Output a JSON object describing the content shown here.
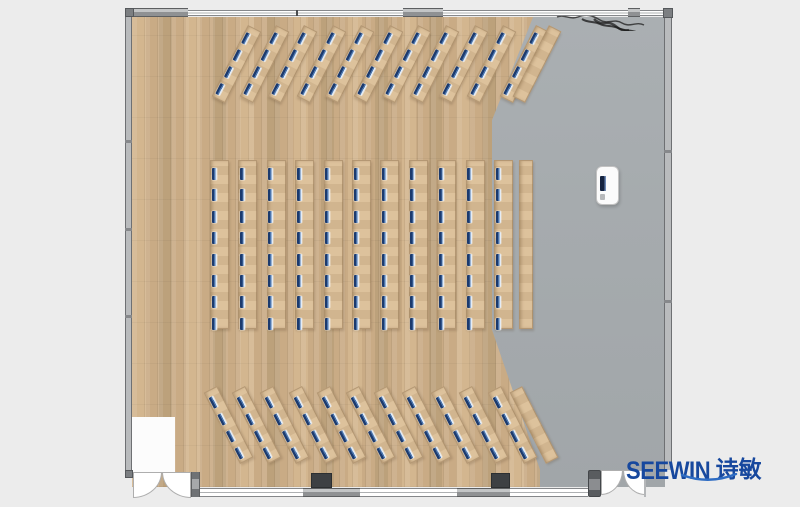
{
  "title": "training-room floor plan",
  "logo": {
    "brand": "SEEWIN",
    "cn": "诗敏"
  },
  "theme": {
    "bg": "#ececec",
    "wood": "#c9ab85",
    "wood_hi": "#d3b68f",
    "wood_lo": "#bca17b",
    "gray_floor": "#a6abae",
    "wall_solid": "#8f9193",
    "wall_light": "#c3c5c6",
    "wall_dark": "#5d5f61",
    "wall_post": "#7c7f82",
    "wall_window": "#ffffff",
    "pilaster": "#3d4043",
    "desk": "#dabd95",
    "chair_dark": "#1c3a6d",
    "chair_mid": "#4a74ad",
    "chair_light": "#e4ecf5",
    "logo_blue": "#17489e",
    "swoosh": "#2e6cc3",
    "lectern_screen": "#15233f"
  },
  "plan": {
    "room": {
      "x": 125,
      "y": 8,
      "w": 547,
      "h": 489
    },
    "sections": [
      {
        "name": "top-angled-rows",
        "rot": 27,
        "count": 11,
        "chairs": 4,
        "cx0": 236,
        "cy": 64,
        "dx": 28.4,
        "last_extra": 4,
        "plain_dx": 13,
        "len": 80,
        "w": 15,
        "chair_y0": 6,
        "chair_dy": 19,
        "plain_w": 14
      },
      {
        "name": "middle-straight-rows",
        "rot": 0,
        "count": 11,
        "chairs": 8,
        "cx0": 219.5,
        "cy": 244.5,
        "dx": 28.4,
        "last_extra": 0,
        "plain_dx": 22,
        "len": 169,
        "w": 19,
        "chair_y0": 7,
        "chair_dy": 21.4,
        "plain_w": 14
      },
      {
        "name": "bottom-angled-rows",
        "rot": -27,
        "count": 11,
        "chairs": 4,
        "cx0": 228,
        "cy": 425,
        "dx": 28.4,
        "last_extra": 0,
        "plain_dx": 22,
        "len": 80,
        "w": 15,
        "chair_y0": 6,
        "chair_dy": 19,
        "plain_w": 14
      }
    ],
    "lectern": {
      "x": 596,
      "y": 166,
      "w": 23,
      "h": 39
    },
    "doors": [
      {
        "name": "double-door-bottom-left",
        "x": 133,
        "w": 58
      },
      {
        "name": "double-door-bottom-right",
        "x": 601,
        "w": 44
      }
    ],
    "annotation": {
      "type": "handwritten-scribble",
      "x": 556,
      "y": 12
    }
  }
}
